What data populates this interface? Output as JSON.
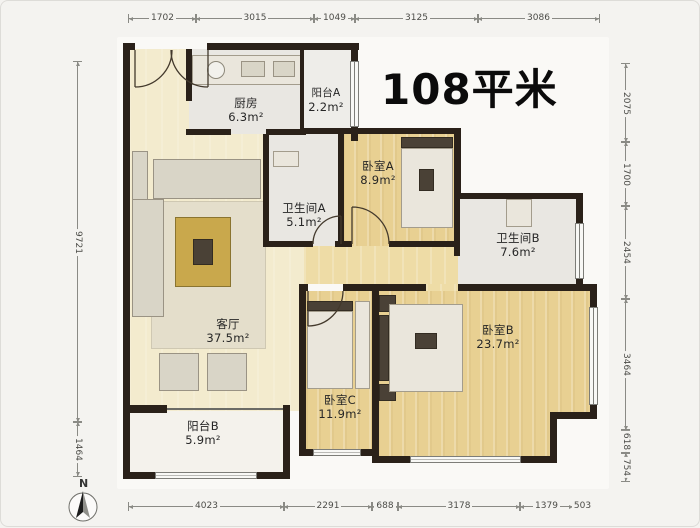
{
  "title": "108平米",
  "compass": {
    "label": "N"
  },
  "dims": {
    "top": [
      "1702",
      "3015",
      "1049",
      "3125",
      "3086"
    ],
    "bottom": [
      "4023",
      "2291",
      "688",
      "3178",
      "1379",
      "503"
    ],
    "left": [
      "9721",
      "1464"
    ],
    "right": [
      "2075",
      "1700",
      "2454",
      "3464",
      "618",
      "754"
    ]
  },
  "rooms": {
    "kitchen": {
      "name": "厨房",
      "area": "6.3m²"
    },
    "balcony_a": {
      "name": "阳台A",
      "area": "2.2m²"
    },
    "bedroom_a": {
      "name": "卧室A",
      "area": "8.9m²"
    },
    "bath_a": {
      "name": "卫生间A",
      "area": "5.1m²"
    },
    "bath_b": {
      "name": "卫生间B",
      "area": "7.6m²"
    },
    "living": {
      "name": "客厅",
      "area": "37.5m²"
    },
    "bedroom_b": {
      "name": "卧室B",
      "area": "23.7m²"
    },
    "bedroom_c": {
      "name": "卧室C",
      "area": "11.9m²"
    },
    "balcony_b": {
      "name": "阳台B",
      "area": "5.9m²"
    }
  },
  "colors": {
    "wall": "#2a2119",
    "floor_wood": "#e8d092",
    "floor_cream": "#f3ebce",
    "floor_tile": "#e9e7e2",
    "table_accent": "#c9a84c",
    "background": "#f4f3f0"
  }
}
